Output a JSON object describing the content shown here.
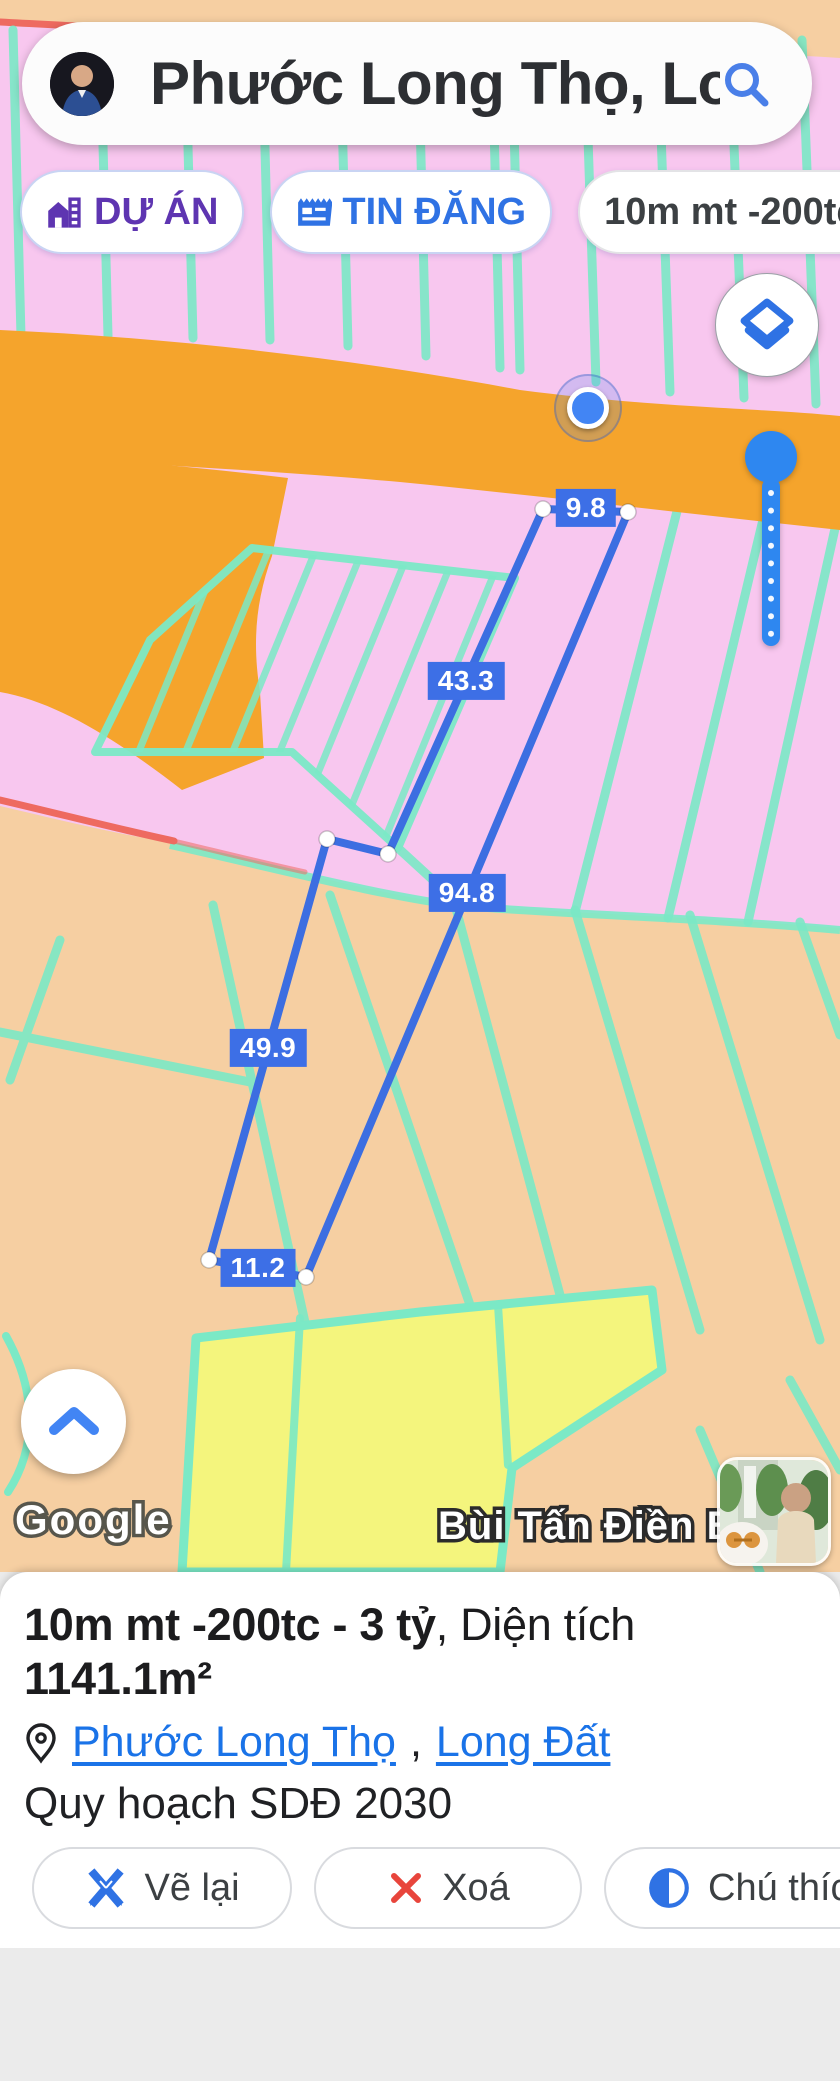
{
  "theme": {
    "accent-blue": "#2f72e4",
    "purple": "#5e35b1",
    "link-blue": "#1a73e8",
    "measure-blue": "#3c6ee1",
    "label-blue": "#3d6fe6",
    "marker-blue": "#4285f4",
    "delete-red": "#e8453c",
    "map-pink": "#f8c7ef",
    "map-tan": "#f6cfa2",
    "map-orange": "#f5a42c",
    "map-yellow": "#f4f57d",
    "map-teal": "#7be9c6",
    "map-red-line": "#ee6a60",
    "bottom-gray": "#ebebeb"
  },
  "search": {
    "query": "Phước Long Thọ, Lon...",
    "icon": "search-icon"
  },
  "chips": {
    "du_an": "DỰ ÁN",
    "tin_dang": "TIN ĐĂNG",
    "listing": "10m mt -200tc - 3"
  },
  "map": {
    "measurements": {
      "top": "9.8",
      "left_upper": "43.3",
      "right_long": "94.8",
      "left_lower": "49.9",
      "bottom": "11.2"
    },
    "attribution": "Google",
    "watermark": "Bùi Tấn Điền BĐS"
  },
  "panel": {
    "title_bold": "10m mt -200tc - 3 tỷ",
    "title_regular": ", Diện tích ",
    "area": "1141.1m²",
    "location": {
      "link1": "Phước Long Thọ",
      "separator": ", ",
      "link2": "Long Đất"
    },
    "planning": "Quy hoạch SDĐ 2030",
    "buttons": {
      "redraw": "Vẽ lại",
      "delete": "Xoá",
      "legend": "Chú thíc"
    }
  }
}
